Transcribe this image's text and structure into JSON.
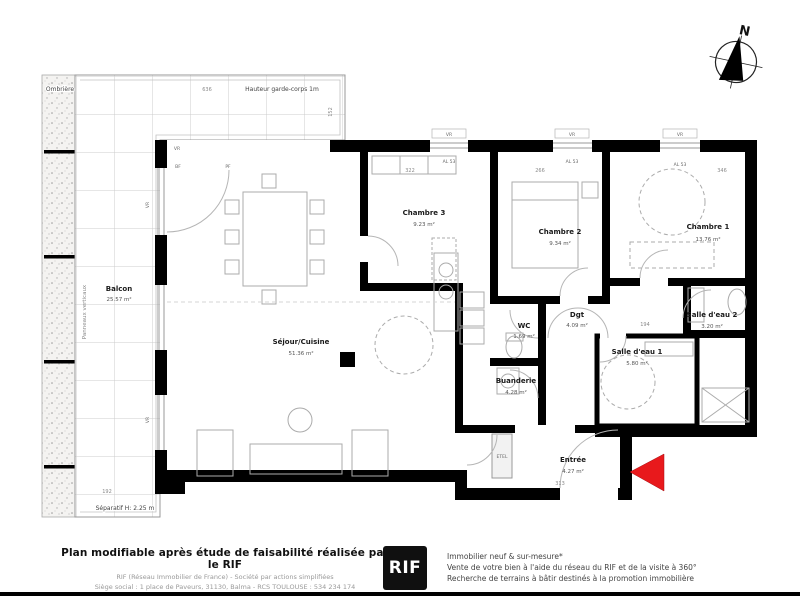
{
  "plan": {
    "compass_label": "N",
    "annotations": {
      "ombriere": "Ombrière",
      "garde_corps": "Hauteur garde-corps 1m",
      "panneaux_verticaux": "Panneaux verticaux",
      "separatif": "Séparatif H: 2.25 m",
      "etel": "ETEL"
    },
    "rooms": [
      {
        "name": "Balcon",
        "area": "25.57 m²"
      },
      {
        "name": "Séjour/Cuisine",
        "area": "51.36 m²"
      },
      {
        "name": "Chambre 3",
        "area": "9.23 m²"
      },
      {
        "name": "Chambre 2",
        "area": "9.34 m²"
      },
      {
        "name": "Chambre 1",
        "area": "13.76 m²"
      },
      {
        "name": "WC",
        "area": "1.69 m²"
      },
      {
        "name": "Dgt",
        "area": "4.09 m²"
      },
      {
        "name": "Salle d'eau 2",
        "area": "3.20 m²"
      },
      {
        "name": "Salle d'eau 1",
        "area": "5.80 m²"
      },
      {
        "name": "Buanderie",
        "area": "4.28 m²"
      },
      {
        "name": "Entrée",
        "area": "4.27 m²"
      }
    ],
    "window_labels": {
      "vr": "VR",
      "al53": "AL 53",
      "bf": "BF",
      "pf": "PF"
    },
    "dimensions": [
      "636",
      "152",
      "322",
      "266",
      "346",
      "194",
      "313",
      "192"
    ],
    "colors": {
      "wall": "#000000",
      "arrow": "#e8191c",
      "lines": "#9b9b9b"
    }
  },
  "footer": {
    "disclaimer": "Plan modifiable après étude de faisabilité réalisée par le RIF",
    "company_line1": "RIF (Réseau Immobilier de France) - Société par actions simplifiées",
    "company_line2": "Siège social : 1 place de Paveurs, 31130, Balma - RCS TOULOUSE : 534 234 174",
    "logo_text": "RIF",
    "services": [
      "Immobilier neuf & sur-mesure*",
      "Vente de votre bien à l'aide du réseau du RIF et de la visite à 360°",
      "Recherche de terrains à bâtir destinés à la promotion immobilière"
    ]
  }
}
